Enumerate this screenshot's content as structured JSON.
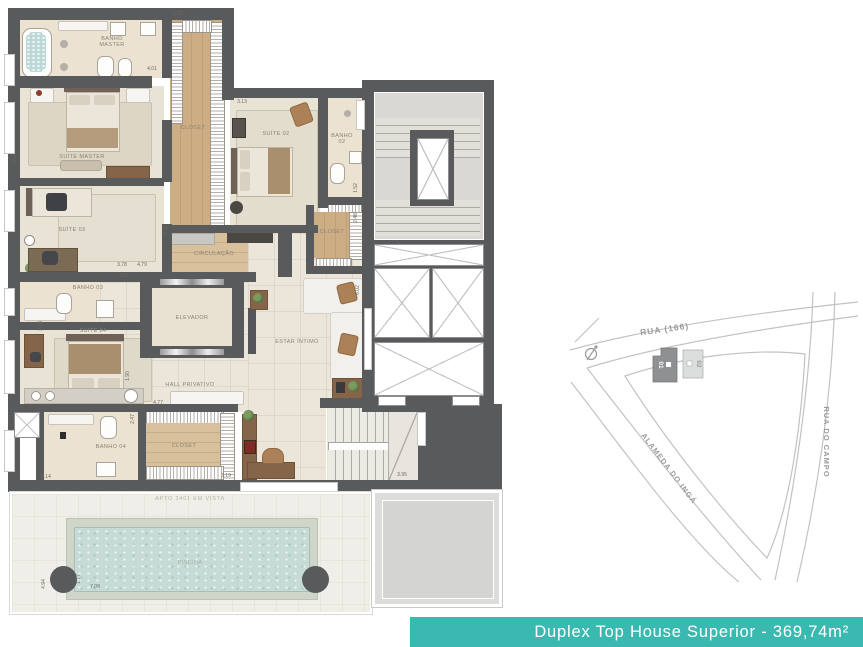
{
  "banner": {
    "title": "Duplex Top House Superior - 369,74m²"
  },
  "colors": {
    "accent_teal": "#3ab9b1",
    "wall_gray": "#595a5c",
    "pool_water": "#c6dbd6",
    "wood": "#cdae84"
  },
  "plan": {
    "labels": {
      "banho_master": "BANHO MASTER",
      "closet_master": "CLOSET",
      "suite_master": "SUÍTE MASTER",
      "suite_02": "SUÍTE 02",
      "banho_02": "BANHO 02",
      "closet_02": "CLOSET",
      "suite_03": "SUÍTE 03",
      "circulacao": "CIRCULAÇÃO",
      "banho_03": "BANHO 03",
      "suite_04": "SUÍTE 04",
      "elevador": "ELEVADOR",
      "hall_privativo": "HALL PRIVATIVO",
      "estar_intimo": "ESTAR ÍNTIMO",
      "banho_04": "BANHO 04",
      "closet_04": "CLOSET",
      "piscina": "PISCINA",
      "apto_note": "APTO 3401 EM VISTA"
    },
    "dims": [
      "4.01",
      "1.73",
      "4.02",
      "3.13",
      "1.52",
      "2.48",
      "2.61",
      "3.78",
      "4.79",
      "3.97",
      "6.02",
      "1.90",
      "4.77",
      "3.19",
      "3.95",
      "3.14",
      "2.47",
      "2.38",
      "1.77",
      "7.08",
      "4.94",
      "4.92"
    ]
  },
  "map": {
    "streets": {
      "top": "RUA (166)",
      "right": "RUA DO CAMPO",
      "left": "ALAMEDA DO INGÁ"
    },
    "buildings": {
      "b1": "01",
      "b2": "02"
    }
  }
}
